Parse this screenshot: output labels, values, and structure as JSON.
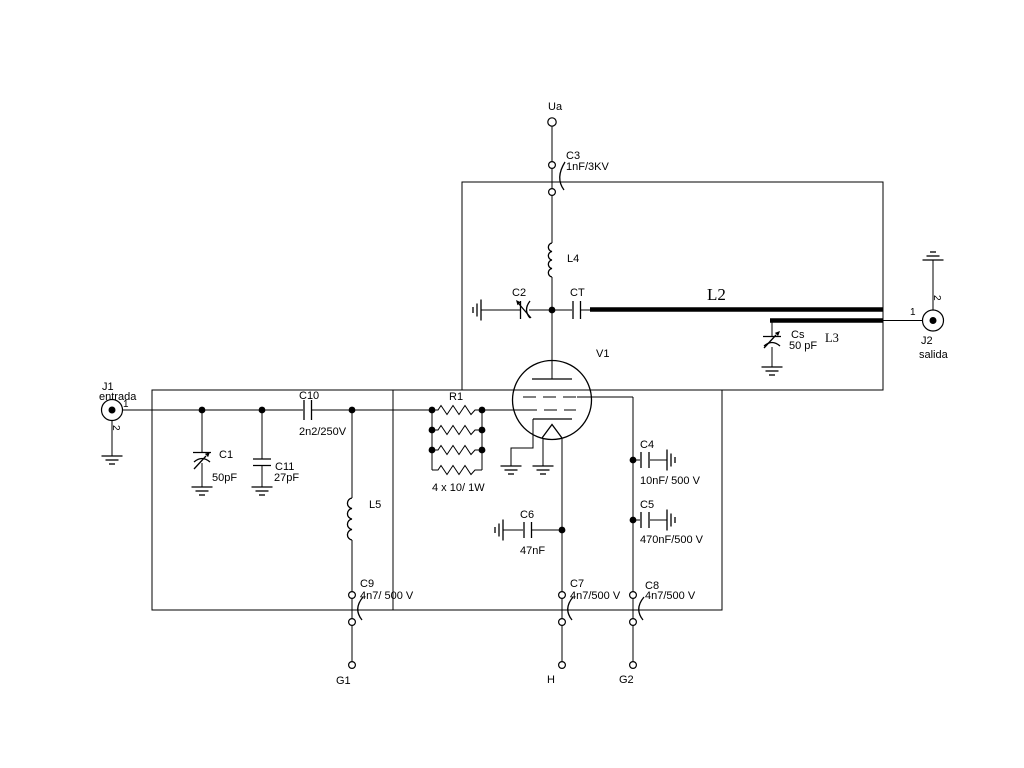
{
  "schematic": {
    "colors": {
      "line": "#000000",
      "background": "#ffffff"
    },
    "power_rail": {
      "label": "Ua"
    },
    "connectors": {
      "j1": {
        "ref": "J1",
        "label": "entrada",
        "pin1": "1",
        "pin2": "2"
      },
      "j2": {
        "ref": "J2",
        "label": "salida",
        "pin1": "1",
        "pin2": "2"
      }
    },
    "tube": {
      "ref": "V1"
    },
    "resistors": {
      "r1": {
        "ref": "R1",
        "value": "4 x 10/ 1W"
      }
    },
    "inductors": {
      "l2": {
        "ref": "L2"
      },
      "l3": {
        "ref": "L3"
      },
      "l4": {
        "ref": "L4"
      },
      "l5": {
        "ref": "L5"
      }
    },
    "capacitors": {
      "c1": {
        "ref": "C1",
        "value": "50pF"
      },
      "c2": {
        "ref": "C2"
      },
      "c3": {
        "ref": "C3",
        "value": "1nF/3KV"
      },
      "c4": {
        "ref": "C4",
        "value": "10nF/ 500 V"
      },
      "c5": {
        "ref": "C5",
        "value": "470nF/500 V"
      },
      "c6": {
        "ref": "C6",
        "value": "47nF"
      },
      "c7": {
        "ref": "C7",
        "value": "4n7/500 V"
      },
      "c8": {
        "ref": "C8",
        "value": "4n7/500 V"
      },
      "c9": {
        "ref": "C9",
        "value": "4n7/ 500 V"
      },
      "c10": {
        "ref": "C10",
        "value": "2n2/250V"
      },
      "c11": {
        "ref": "C11",
        "value": "27pF"
      },
      "ct": {
        "ref": "CT"
      },
      "cs": {
        "ref": "Cs",
        "value": "50 pF"
      }
    },
    "terminals": {
      "g1": "G1",
      "h": "H",
      "g2": "G2"
    }
  }
}
